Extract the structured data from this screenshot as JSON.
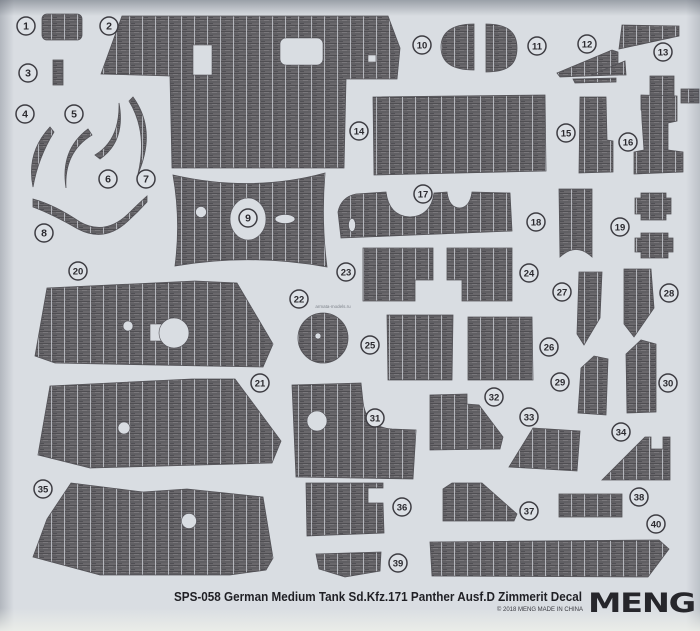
{
  "sheet": {
    "title": "SPS-058 German Medium Tank Sd.Kfz.171 Panther Ausf.D Zimmerit Decal",
    "copyright": "© 2018 MENG  MADE IN CHINA",
    "brand_logo": "MENG",
    "watermark": "armata-models.ru",
    "colors": {
      "background": "#d9dde2",
      "piece_base": "#6a686c",
      "piece_shadow": "#4f4e52",
      "seam": "#c2c6cb",
      "badge_stroke": "#3e3d43",
      "text": "#1f1f24"
    },
    "part_count": 40
  },
  "parts": [
    {
      "num": 1,
      "x": 26,
      "y": 26
    },
    {
      "num": 2,
      "x": 109,
      "y": 26
    },
    {
      "num": 3,
      "x": 28,
      "y": 73
    },
    {
      "num": 4,
      "x": 25,
      "y": 114
    },
    {
      "num": 5,
      "x": 74,
      "y": 114
    },
    {
      "num": 6,
      "x": 108,
      "y": 179
    },
    {
      "num": 7,
      "x": 146,
      "y": 179
    },
    {
      "num": 8,
      "x": 44,
      "y": 233
    },
    {
      "num": 9,
      "x": 248,
      "y": 218
    },
    {
      "num": 10,
      "x": 422,
      "y": 45
    },
    {
      "num": 11,
      "x": 537,
      "y": 46
    },
    {
      "num": 12,
      "x": 587,
      "y": 44
    },
    {
      "num": 13,
      "x": 663,
      "y": 52
    },
    {
      "num": 14,
      "x": 359,
      "y": 131
    },
    {
      "num": 15,
      "x": 566,
      "y": 133
    },
    {
      "num": 16,
      "x": 628,
      "y": 142
    },
    {
      "num": 17,
      "x": 423,
      "y": 194
    },
    {
      "num": 18,
      "x": 536,
      "y": 222
    },
    {
      "num": 19,
      "x": 620,
      "y": 227
    },
    {
      "num": 20,
      "x": 78,
      "y": 271
    },
    {
      "num": 21,
      "x": 260,
      "y": 383
    },
    {
      "num": 22,
      "x": 299,
      "y": 299
    },
    {
      "num": 23,
      "x": 346,
      "y": 272
    },
    {
      "num": 24,
      "x": 529,
      "y": 273
    },
    {
      "num": 25,
      "x": 370,
      "y": 345
    },
    {
      "num": 26,
      "x": 549,
      "y": 347
    },
    {
      "num": 27,
      "x": 562,
      "y": 292
    },
    {
      "num": 28,
      "x": 669,
      "y": 293
    },
    {
      "num": 29,
      "x": 560,
      "y": 382
    },
    {
      "num": 30,
      "x": 668,
      "y": 383
    },
    {
      "num": 31,
      "x": 375,
      "y": 418
    },
    {
      "num": 32,
      "x": 494,
      "y": 397
    },
    {
      "num": 33,
      "x": 529,
      "y": 417
    },
    {
      "num": 34,
      "x": 621,
      "y": 432
    },
    {
      "num": 35,
      "x": 43,
      "y": 489
    },
    {
      "num": 36,
      "x": 402,
      "y": 507
    },
    {
      "num": 37,
      "x": 529,
      "y": 511
    },
    {
      "num": 38,
      "x": 639,
      "y": 497
    },
    {
      "num": 39,
      "x": 398,
      "y": 563
    },
    {
      "num": 40,
      "x": 656,
      "y": 524
    }
  ]
}
